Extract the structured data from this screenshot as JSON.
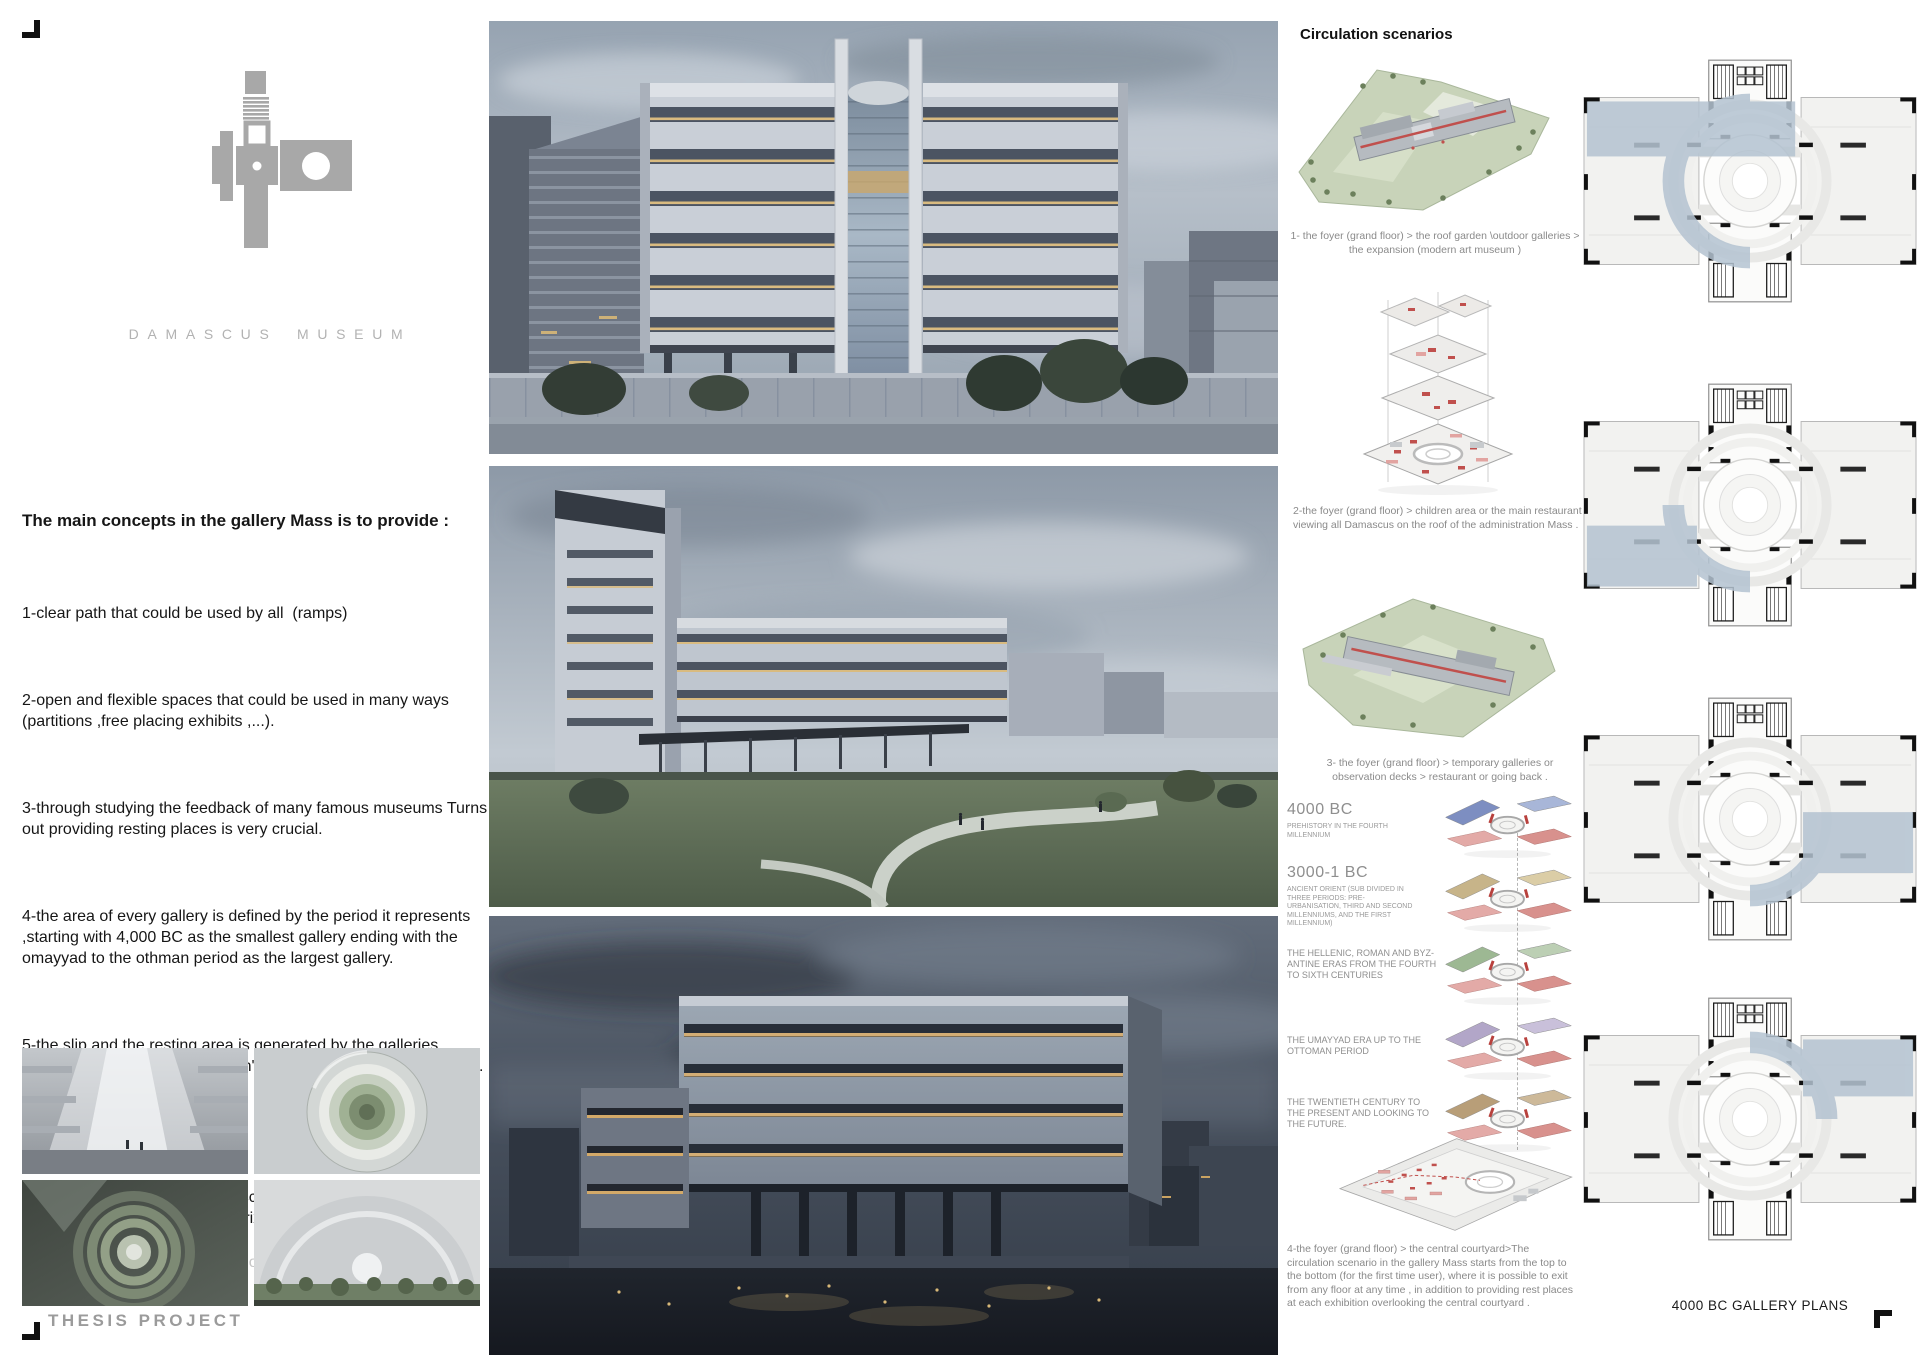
{
  "brand": {
    "name": "DAMASCUS MUSEUM",
    "project_label": "THESIS PROJECT"
  },
  "concepts": {
    "heading": "The main concepts in the gallery Mass is to provide :",
    "items": [
      "1-clear path that could be used by all  (ramps)",
      "2-open and flexible spaces that could be used in many ways (partitions ,free placing exhibits ,...).",
      "3-through studying the feedback of many famous museums Turns out providing resting places is very crucial.",
      "4-the area of every gallery is defined by the period it represents ,starting with 4,000 BC as the smallest gallery ending with the omayyad to the othman period as the largest gallery.",
      "5-the slip and the resting area is generated by the galleries indicates that : the history doesn't go in one way there's overlaps."
    ],
    "video_note": "A video clarifies the circulation scenario in the gallery mass. Part of my participation in the Archiprix International Competition.",
    "video_url": "https://youtu.be/dheRLnvqmno"
  },
  "circulation": {
    "heading": "Circulation scenarios",
    "captions": [
      "1- the foyer (grand floor) > the roof garden \\outdoor galleries > the expansion (modern art museum )",
      "2-the foyer (grand floor) > children area or the main restaurant viewing all Damascus on the roof of the administration Mass .",
      "3- the foyer (grand floor) > temporary galleries or observation decks > restaurant or going back .",
      "4-the foyer (grand floor) > the central courtyard>The circulation scenario in the gallery Mass starts from the top to the bottom (for the first time user), where it is possible to exit from any floor at any time , in addition to providing rest places at each exhibition overlooking the central courtyard ."
    ]
  },
  "timeline": {
    "entries": [
      {
        "title": "4000 BC",
        "desc": "PREHISTORY IN THE FOURTH MILLENNIUM",
        "color": "#7d8ec1",
        "color2": "#a8b6d8"
      },
      {
        "title": "3000-1 BC",
        "desc": "ANCIENT ORIENT (SUB DIVIDED IN THREE PERIODS: PRE-URBANISATION, THIRD AND SECOND MILLENNIUMS, AND THE FIRST MILLENNIUM)",
        "color": "#c7b489",
        "color2": "#dbcda6"
      },
      {
        "title": "",
        "desc": "THE HELLENIC, ROMAN AND BYZ-ANTINE ERAS FROM THE FOURTH TO SIXTH CENTURIES",
        "color": "#9db893",
        "color2": "#bccfb4"
      },
      {
        "title": "",
        "desc": "THE UMAYYAD ERA UP TO THE OTTOMAN PERIOD",
        "color": "#b2a6c8",
        "color2": "#c9c0da"
      },
      {
        "title": "",
        "desc": "THE TWENTIETH CENTURY TO THE PRESENT AND LOOKING TO THE FUTURE.",
        "color": "#b89e78",
        "color2": "#cdb999"
      }
    ]
  },
  "plans": {
    "caption": "4000 BC GALLERY PLANS"
  },
  "colors": {
    "gallery_highlight": "#b4c3d1",
    "accent_red": "#c0504d",
    "accent_pink": "#e2a4a1",
    "logo_gray": "#a8a8a8"
  }
}
